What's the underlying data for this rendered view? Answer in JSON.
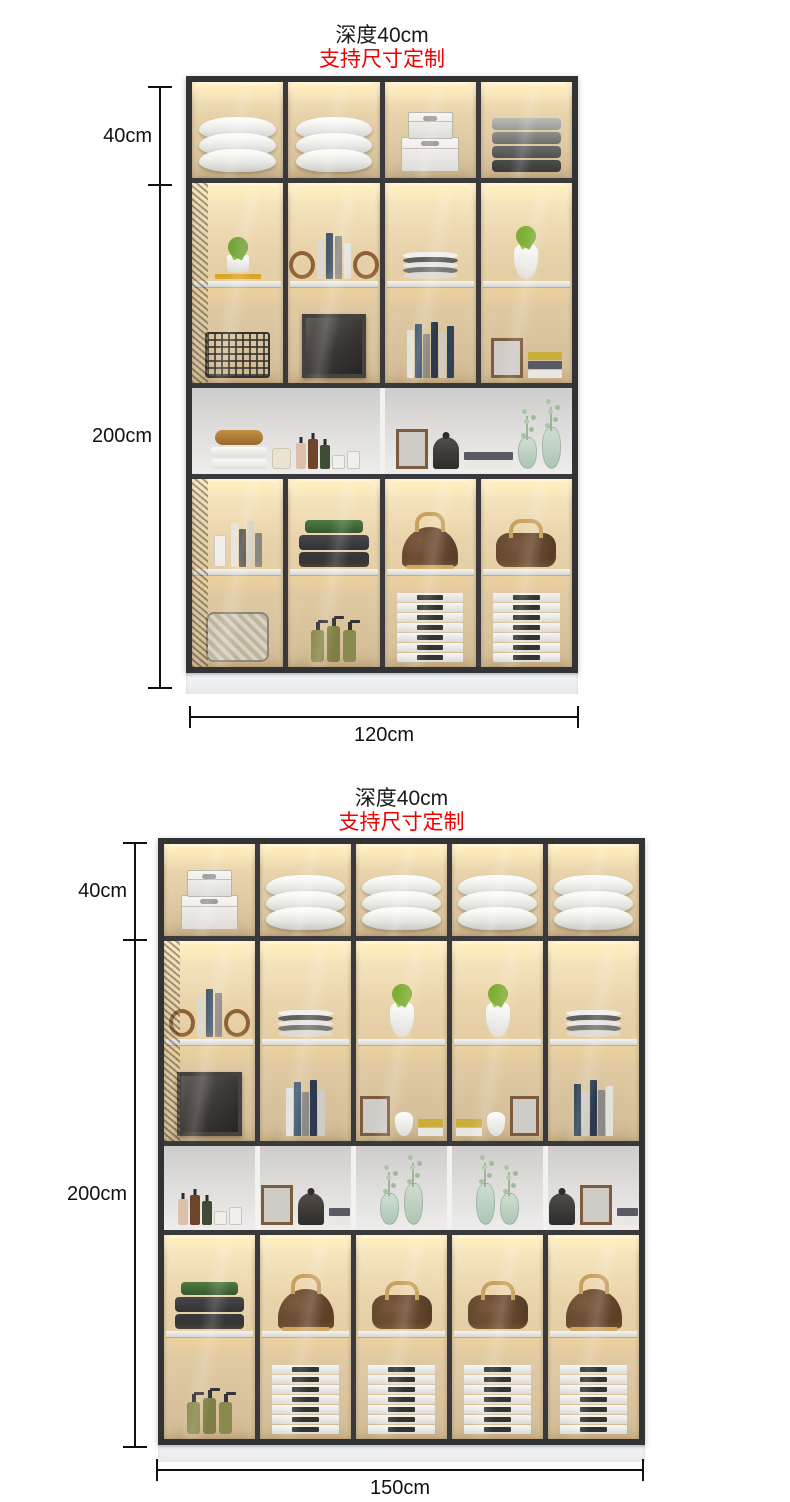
{
  "page": {
    "background": "#ffffff",
    "type": "furniture dimension spec image"
  },
  "colors": {
    "accent_red": "#f20000",
    "text": "#1a1a1a",
    "frame": "#3a3a3c",
    "led_warm": "#f6e4bd",
    "plinth": "#eef1f2"
  },
  "figures": [
    {
      "title_depth": "深度40cm",
      "title_custom": "支持尺寸定制",
      "dim_top": "40cm",
      "dim_total": "200cm",
      "dim_width": "120cm",
      "columns": 4,
      "contents": {
        "top_row": [
          "pillow-stack",
          "pillow-stack",
          "storage-boxes",
          "folded-blankets"
        ],
        "upper_glass_shelf1": [
          "potted-plant",
          "books-with-bookends",
          "plate-stack",
          "vase-with-succulent"
        ],
        "upper_glass_shelf2": [
          "wire-basket",
          "large-picture-frame",
          "book-row",
          "small-frame-and-books"
        ],
        "open_display": [
          "towels-and-toiletries",
          "frame-cloche-books-and-glass-vases"
        ],
        "lower_glass_shelf1": [
          "books",
          "folded-blankets-green-gray",
          "alma-handbag",
          "speedy-handbag"
        ],
        "lower_glass_shelf2": [
          "woven-basket",
          "pump-bottles",
          "white-book-stack",
          "white-book-stack"
        ]
      }
    },
    {
      "title_depth": "深度40cm",
      "title_custom": "支持尺寸定制",
      "dim_top": "40cm",
      "dim_total": "200cm",
      "dim_width": "150cm",
      "columns": 5,
      "contents": {
        "top_row": [
          "storage-boxes",
          "pillow-stack",
          "pillow-stack",
          "pillow-stack",
          "pillow-stack"
        ],
        "upper_glass_shelf1": [
          "books-with-bookends",
          "plate-stack",
          "vase-with-succulent",
          "vase-with-succulent",
          "plate-stack"
        ],
        "upper_glass_shelf2": [
          "large-picture-frame",
          "book-row",
          "frame-vase-flowers-books",
          "frame-vase-flowers-books",
          "book-row"
        ],
        "open_display": [
          "toiletries-tray",
          "frame-cloche-books",
          "glass-vases",
          "glass-vases",
          "cloche-frame-books"
        ],
        "lower_glass_shelf1": [
          "folded-blankets-green-black",
          "alma-handbag",
          "speedy-handbag",
          "speedy-handbag",
          "alma-handbag"
        ],
        "lower_glass_shelf2": [
          "pump-bottles",
          "white-book-stack",
          "white-book-stack",
          "white-book-stack",
          "white-book-stack"
        ]
      }
    }
  ]
}
